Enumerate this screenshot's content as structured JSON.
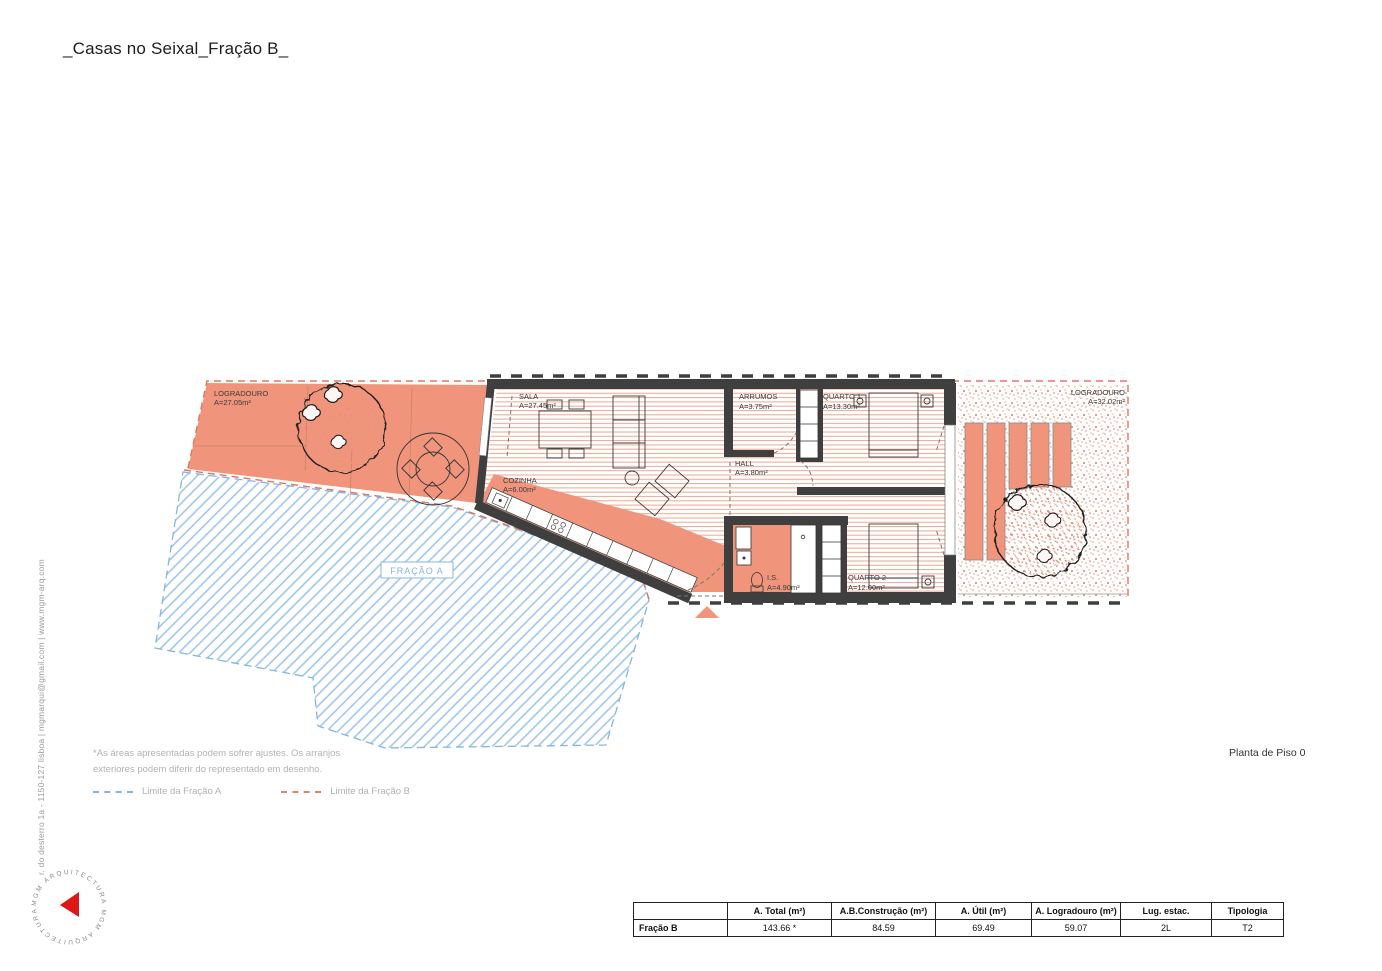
{
  "title": "_Casas no Seixal_Fração B_",
  "contact_strip": "r. do desterro 1a - 1150-127 lisboa | mgmarqui@gmail.com | www.mgm-arq.com",
  "logo": {
    "ring_text": "MGM ARQUITECTURA   MGM ARQUITECTURA",
    "arrow_color": "#e01616"
  },
  "plan": {
    "labels": {
      "logradouro_left": {
        "name": "LOGRADOURO",
        "area": "A=27.05m²"
      },
      "sala": {
        "name": "SALA",
        "area": "A=27.45m²"
      },
      "cozinha": {
        "name": "COZINHA",
        "area": "A=6.00m²"
      },
      "arrumos": {
        "name": "ARRUMOS",
        "area": "A=3.75m²"
      },
      "quarto1": {
        "name": "QUARTO 1",
        "area": "A=13.30m²"
      },
      "hall": {
        "name": "HALL",
        "area": "A=3.80m²"
      },
      "is": {
        "name": "I.S.",
        "area": "A=4.90m²"
      },
      "quarto2": {
        "name": "QUARTO 2",
        "area": "A=12.00m²"
      },
      "logradouro_right": {
        "name": "LOGRADOURO",
        "area": "A=32.02m²"
      },
      "fracao_a": "FRAÇÃO A"
    },
    "colors": {
      "salmon": "#F0957C",
      "wall": "#3F3F3F",
      "blue_dash": "#85B4E8",
      "red_dash": "#DD7861"
    }
  },
  "notes": {
    "line1": "*As áreas apresentadas podem sofrer ajustes. Os arranjos",
    "line2": "exteriores podem diferir do representado em desenho."
  },
  "legend": {
    "fracao_a": "Limite da Fração A",
    "fracao_b": "Limite da Fração B"
  },
  "floor_label": "Planta de Piso 0",
  "table": {
    "headers": [
      "",
      "A. Total (m²)",
      "A.B.Construção (m²)",
      "A. Útil (m²)",
      "A. Logradouro (m²)",
      "Lug. estac.",
      "Tipologia"
    ],
    "row_label": "Fração B",
    "values": [
      "143.66 *",
      "84.59",
      "69.49",
      "59.07",
      "2L",
      "T2"
    ]
  }
}
